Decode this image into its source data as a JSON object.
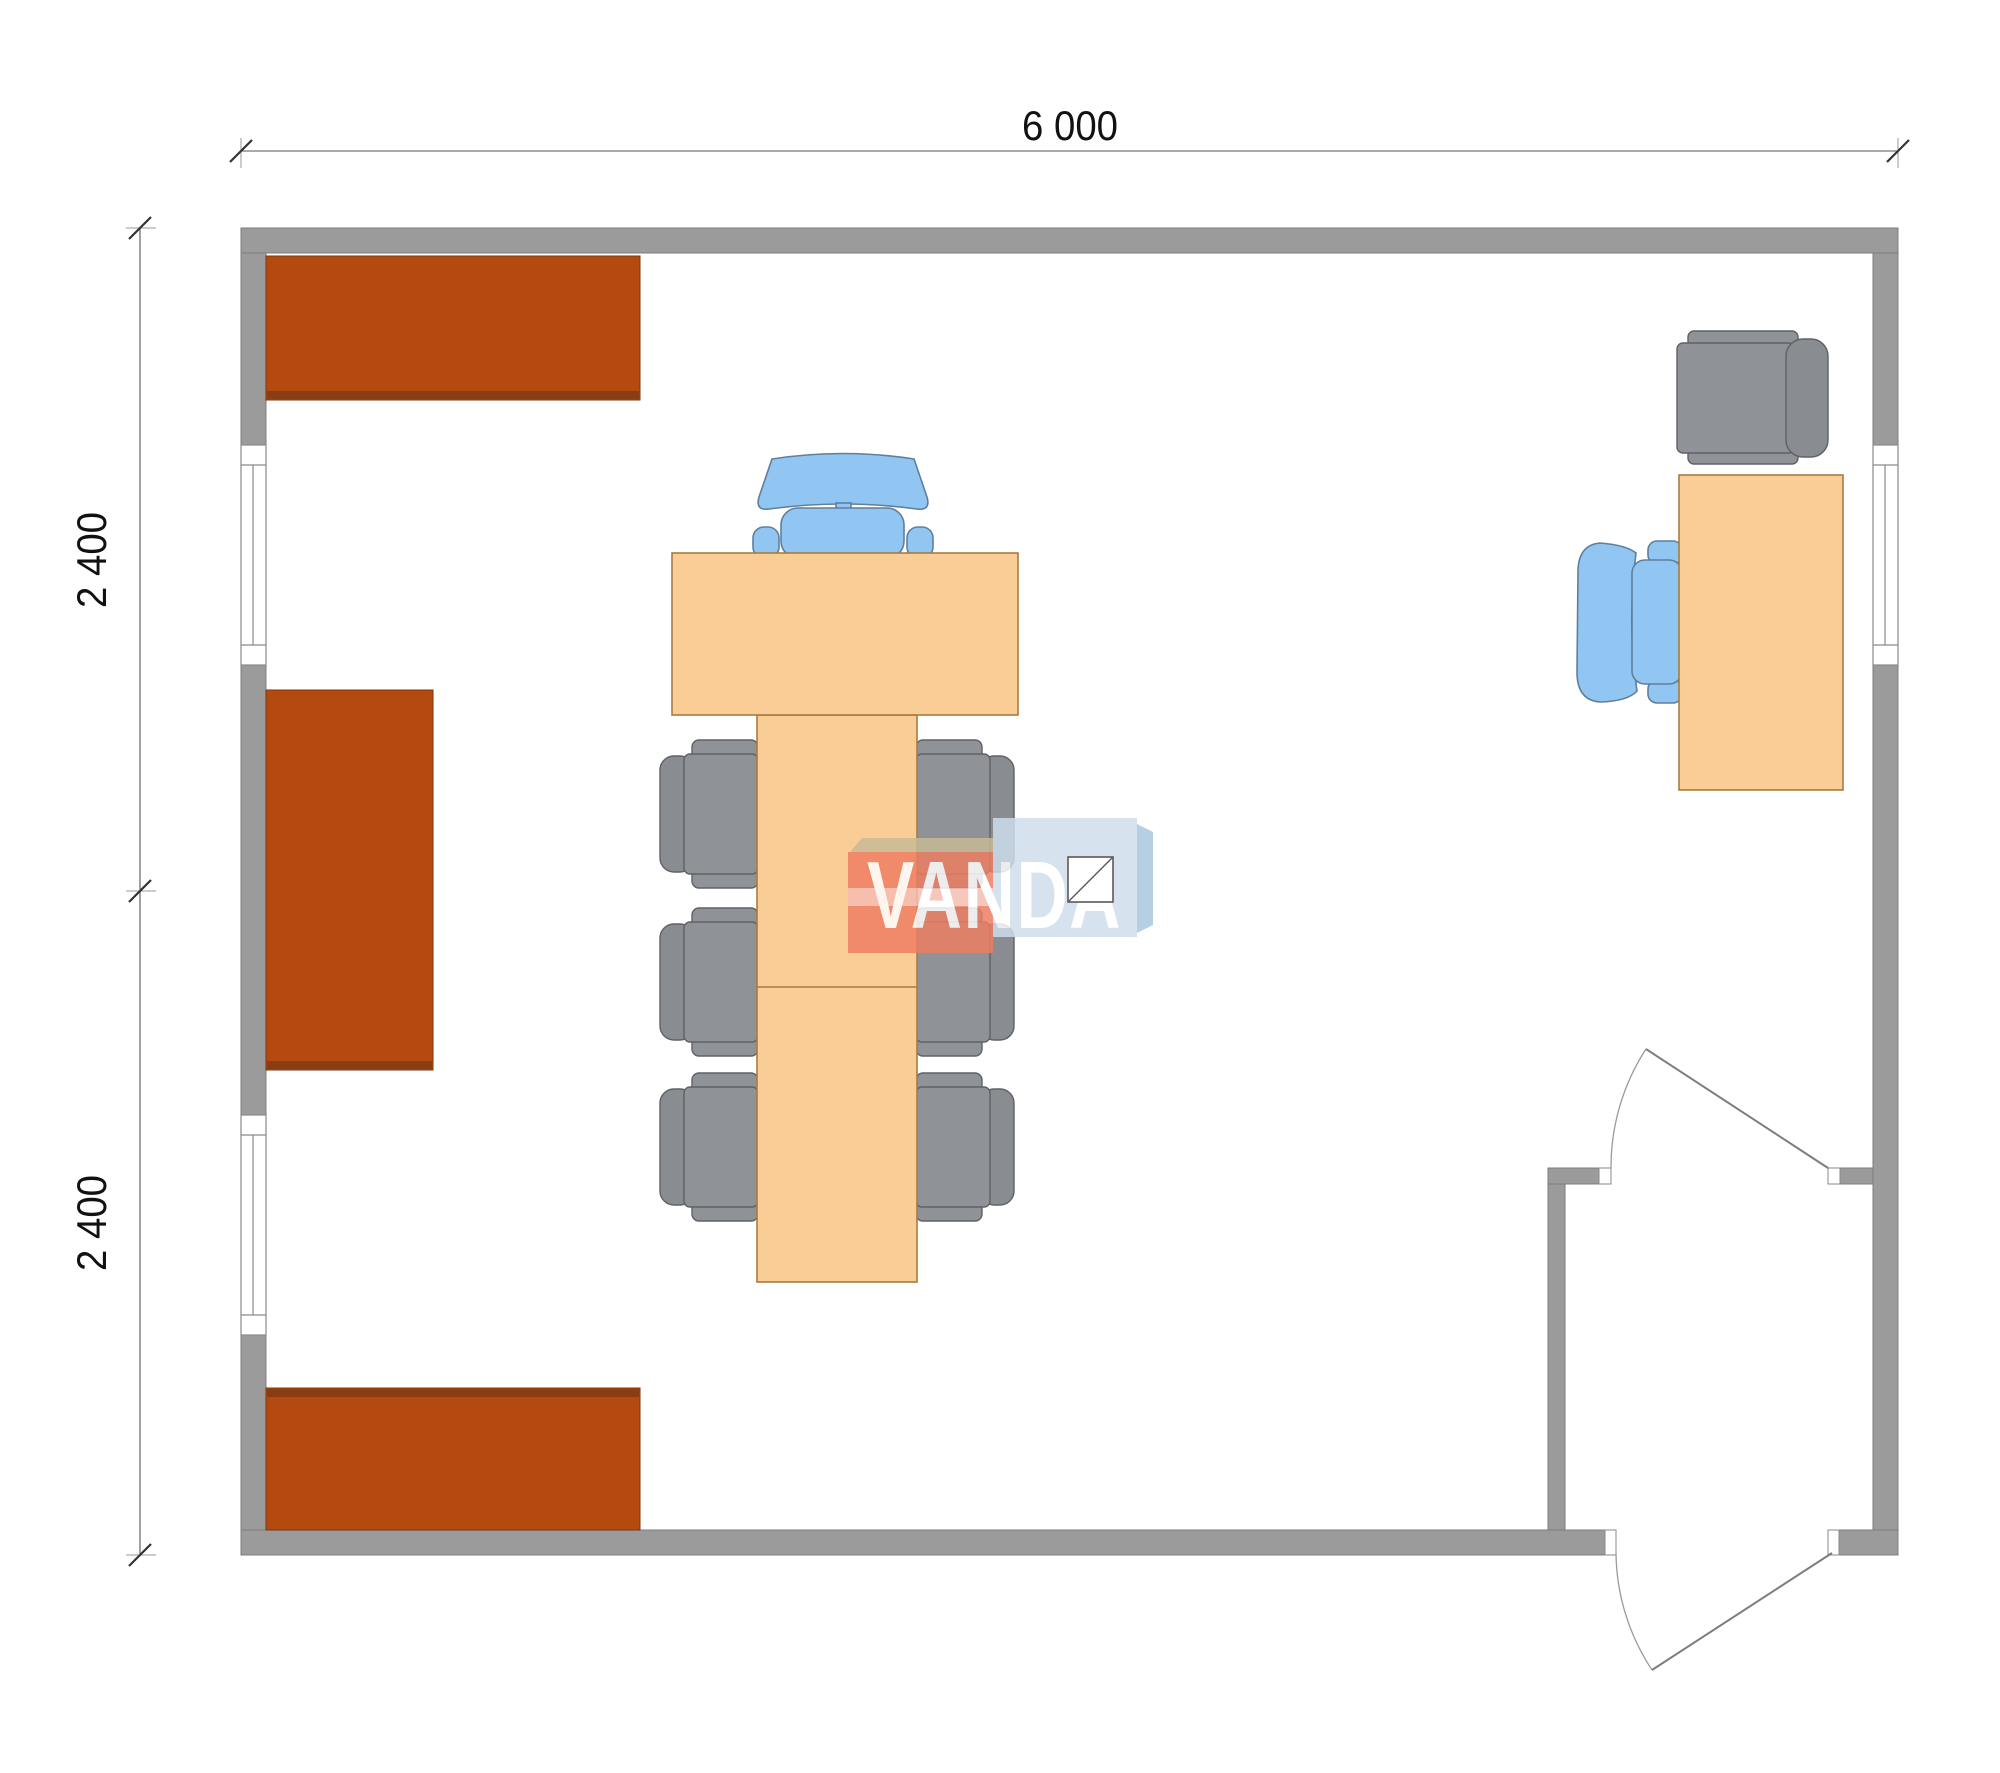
{
  "document": {
    "type": "architectural-floor-plan",
    "room_width_mm": 6000,
    "room_depth_mm": 4800
  },
  "dimensions": {
    "top": {
      "label": "6 000"
    },
    "left_upper": {
      "label": "2 400"
    },
    "left_lower": {
      "label": "2 400"
    }
  },
  "watermark": {
    "text": "VANDA"
  },
  "room": {
    "openings": [
      "window-left-upper",
      "window-left-lower",
      "window-right",
      "interior-door",
      "entrance-door"
    ],
    "furniture": [
      "shelf-top-left",
      "shelf-middle-left",
      "shelf-bottom-left",
      "conference-table-top",
      "conference-table-long",
      "executive-chair-blue",
      "conference-chair-left-1",
      "conference-chair-left-2",
      "conference-chair-left-3",
      "conference-chair-right-1",
      "conference-chair-right-2",
      "conference-chair-right-3",
      "desk",
      "desk-visitor-chair-gray",
      "desk-chair-blue"
    ]
  },
  "colors": {
    "wall": "#9b9b9b",
    "wallLine": "#7c7c7c",
    "shelf": "#b44a10",
    "shelfDark": "#8a3c12",
    "shelfLine": "#7a3510",
    "wood": "#fbcd96",
    "woodLine": "#a87c3e",
    "chair": "#8f9296",
    "chairDark": "#898c90",
    "chairLine": "#5f6165",
    "blue": "#92c6f2",
    "blueLine": "#5e7f9e",
    "dimLine": "#555555",
    "dimText": "#111111",
    "doorLine": "#7d7d7d",
    "arcLine": "#9a9a9a",
    "logoRed": "#ee7e62",
    "logoStripe": "#f6bdb2",
    "logoTan": "#c8ba95",
    "logoBlue": "#cfdeed",
    "logoBlueSide": "#a9c6dd",
    "logoText": "#ffffff"
  }
}
